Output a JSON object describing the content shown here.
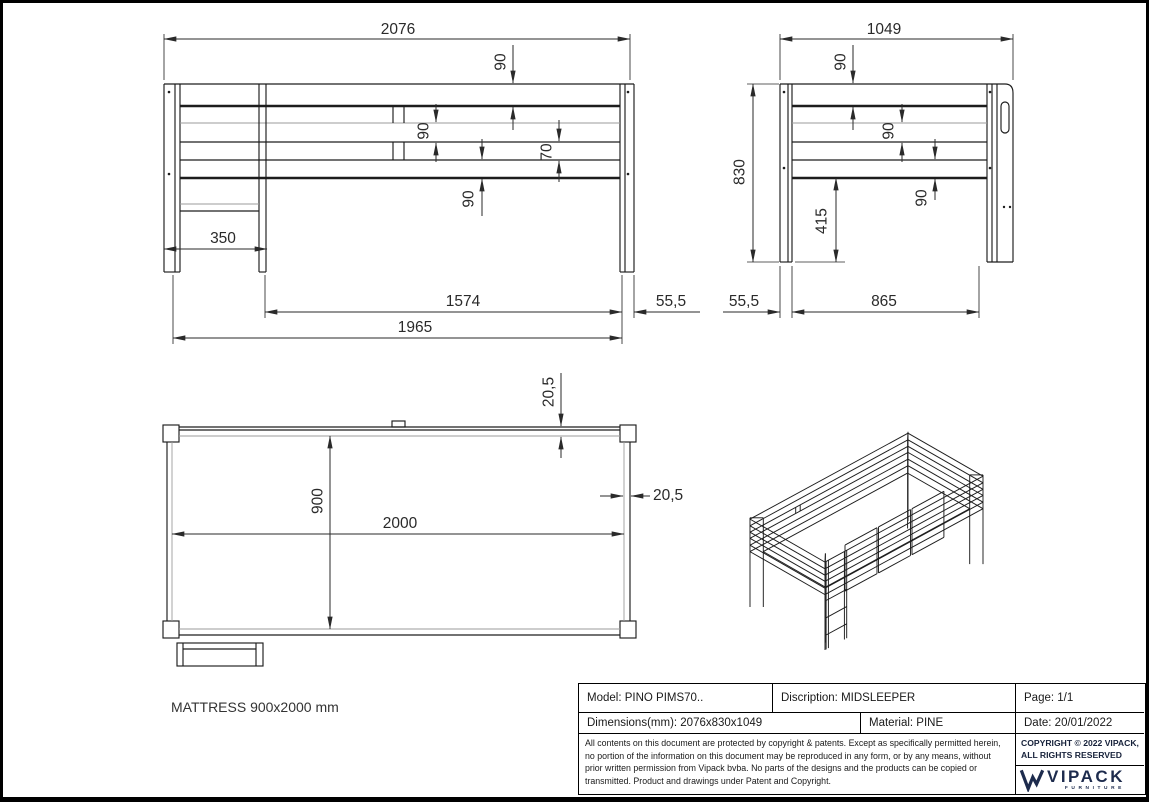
{
  "colors": {
    "background": "#ffffff",
    "line": "#1d1d1d",
    "thin_line": "#9b9b9b",
    "dim_text": "#2a2a2a",
    "brand_navy": "#1d2b4d"
  },
  "front_view": {
    "dim_total_width": "2076",
    "dim_rail_top": "90",
    "dim_rail_mid": "90",
    "dim_rail_gap": "70",
    "dim_rail_low": "90",
    "dim_ladder_offset": "350",
    "dim_span_inner": "1574",
    "dim_span_base": "1965",
    "dim_post_width": "55,5"
  },
  "side_view": {
    "dim_total_depth": "1049",
    "dim_rail_top": "90",
    "dim_rail_mid": "90",
    "dim_rail_low": "90",
    "dim_height": "830",
    "dim_under_clearance": "415",
    "dim_post_width": "55,5",
    "dim_span_inner": "865"
  },
  "top_view": {
    "dim_frame_top": "20,5",
    "dim_width": "900",
    "dim_length": "2000",
    "dim_frame_right": "20,5",
    "mattress_note": "MATTRESS 900x2000 mm"
  },
  "title_block": {
    "model": "Model: PINO PIMS70..",
    "description": "Discription: MIDSLEEPER",
    "page": "Page: 1/1",
    "dimensions": "Dimensions(mm): 2076x830x1049",
    "material": "Material: PINE",
    "date": "Date: 20/01/2022",
    "copyright_notice": "All contents on this document are protected by copyright & patents. Except as specifically permitted herein, no portion of the information on this document may be reproduced in any form, or by any means, without prior written permission from Vipack bvba. No parts of the designs and the products can be copied or transmitted. Product and drawings under Patent and Copyright.",
    "copyright_line1": "COPYRIGHT  © 2022 VIPACK,",
    "copyright_line2": "ALL RIGHTS RESERVED",
    "brand_name": "VIPACK",
    "brand_sub": "FURNITURE"
  }
}
